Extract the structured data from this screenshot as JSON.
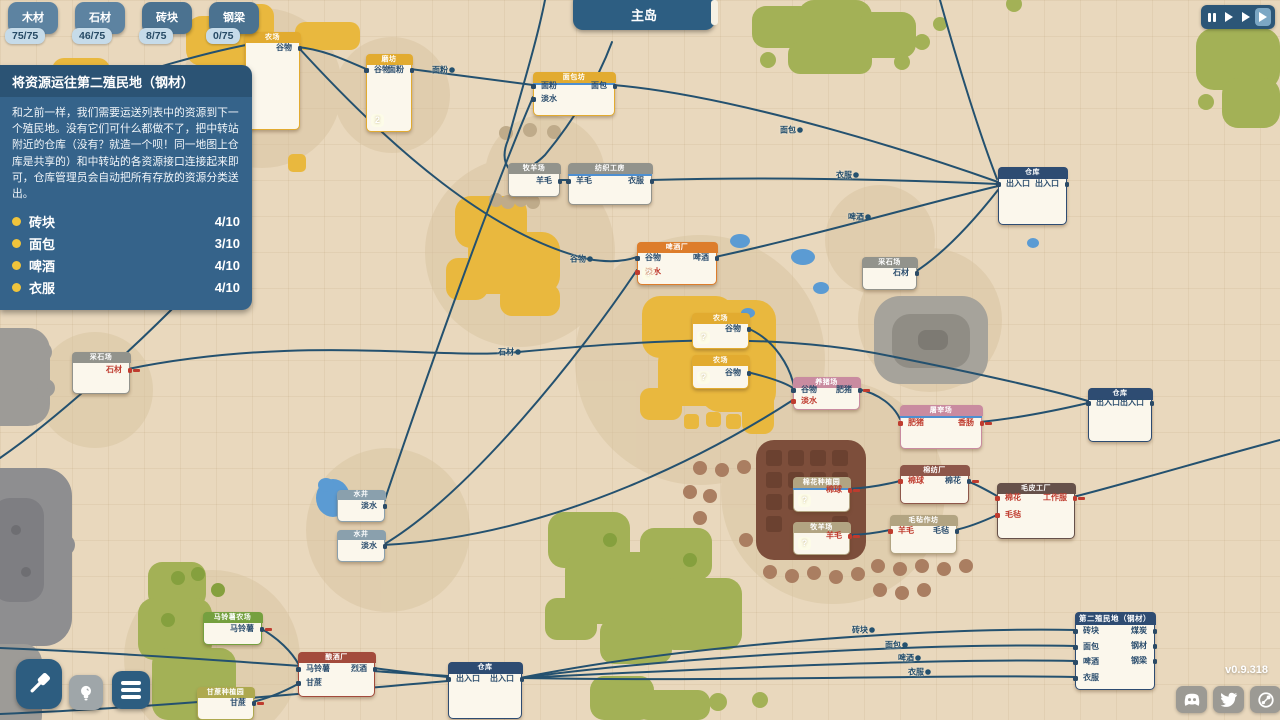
{
  "hud": {
    "map_title": "主岛",
    "version": "v0.9.318",
    "resources": [
      {
        "name": "木材",
        "count": "75/75"
      },
      {
        "name": "石材",
        "count": "46/75"
      },
      {
        "name": "砖块",
        "count": "8/75"
      },
      {
        "name": "钢梁",
        "count": "0/75"
      }
    ],
    "speed_buttons": [
      "pause",
      "play-1x",
      "play-2x",
      "play-3x"
    ],
    "speed_active_index": 3,
    "toolbar": [
      "build-hammer",
      "idea-bulb",
      "menu"
    ],
    "social": [
      "discord",
      "twitter",
      "steam"
    ]
  },
  "quest": {
    "title": "将资源运往第二殖民地（钢材）",
    "body": "和之前一样，我们需要运送列表中的资源到下一个殖民地。没有它们可什么都做不了，把中转站附近的仓库（没有？就造一个呗！同一地图上仓库是共享的）和中转站的各资源接口连接起来即可，仓库管理员会自动把所有存放的资源分类送出。",
    "items": [
      {
        "label": "砖块",
        "progress": "4/10"
      },
      {
        "label": "面包",
        "progress": "3/10"
      },
      {
        "label": "啤酒",
        "progress": "4/10"
      },
      {
        "label": "衣服",
        "progress": "4/10"
      }
    ]
  },
  "palette": {
    "yellow": "#e2ab30",
    "gray": "#92938c",
    "blue": "#2e4c72",
    "orange": "#dd7d2b",
    "pink": "#c98ba0",
    "brown": "#8e574a",
    "darkbrown": "#66514a",
    "tan": "#b2a482",
    "green": "#75a03f",
    "olive": "#aea94f",
    "darkred": "#a34b3c",
    "well": "#8aa0ad",
    "edge": "#24516f",
    "accent_yellow": "#f0c43c"
  },
  "nodes": [
    {
      "id": "farm-topleft",
      "type": "yellow",
      "title": "农场",
      "x": 245,
      "y": 32,
      "w": 53,
      "h": 96,
      "outputs": [
        {
          "label": "谷物",
          "dy": 15
        }
      ]
    },
    {
      "id": "mill",
      "type": "yellow",
      "title": "磨坊",
      "x": 366,
      "y": 54,
      "w": 44,
      "h": 76,
      "badge": "2",
      "inputs": [
        {
          "label": "谷物",
          "dy": 15
        }
      ],
      "outputs": [
        {
          "label": "面粉",
          "dy": 15
        }
      ]
    },
    {
      "id": "bakery",
      "type": "yellow",
      "title": "面包坊",
      "x": 533,
      "y": 72,
      "w": 80,
      "h": 42,
      "progress": true,
      "inputs": [
        {
          "label": "面粉",
          "dy": 13
        },
        {
          "label": "淡水",
          "dy": 26
        }
      ],
      "outputs": [
        {
          "label": "面包",
          "dy": 13
        }
      ]
    },
    {
      "id": "sheepfarm-top",
      "type": "gray",
      "title": "牧羊场",
      "x": 508,
      "y": 163,
      "w": 50,
      "h": 32,
      "outputs": [
        {
          "label": "羊毛",
          "dy": 17
        }
      ]
    },
    {
      "id": "textile",
      "type": "gray",
      "title": "纺织工房",
      "x": 568,
      "y": 163,
      "w": 82,
      "h": 40,
      "progress": true,
      "inputs": [
        {
          "label": "羊毛",
          "dy": 17
        }
      ],
      "outputs": [
        {
          "label": "衣服",
          "dy": 17
        }
      ]
    },
    {
      "id": "warehouse-topright",
      "type": "blue",
      "title": "仓库",
      "x": 998,
      "y": 167,
      "w": 67,
      "h": 56,
      "hh": 12,
      "inputs": [
        {
          "label": "出入口",
          "dy": 16
        }
      ],
      "outputs": [
        {
          "label": "出入口",
          "dy": 16
        }
      ]
    },
    {
      "id": "brewery",
      "type": "orange",
      "title": "啤酒厂",
      "x": 637,
      "y": 242,
      "w": 78,
      "h": 41,
      "badge": "?",
      "inputs": [
        {
          "label": "谷物",
          "dy": 15
        },
        {
          "label": "淡水",
          "dy": 29,
          "red": true
        }
      ],
      "outputs": [
        {
          "label": "啤酒",
          "dy": 15
        }
      ]
    },
    {
      "id": "quarry-right",
      "type": "gray",
      "title": "采石场",
      "x": 862,
      "y": 257,
      "w": 53,
      "h": 31,
      "outputs": [
        {
          "label": "石材",
          "dy": 15
        }
      ]
    },
    {
      "id": "quarry-left",
      "type": "gray",
      "title": "采石场",
      "x": 72,
      "y": 352,
      "w": 56,
      "h": 40,
      "outputs": [
        {
          "label": "石材",
          "dy": 17,
          "red": true,
          "stub": true
        }
      ]
    },
    {
      "id": "farm-mid1",
      "type": "yellow",
      "title": "农场",
      "x": 692,
      "y": 313,
      "w": 55,
      "h": 34,
      "badge": "?",
      "outputs": [
        {
          "label": "谷物",
          "dy": 15
        }
      ]
    },
    {
      "id": "farm-mid2",
      "type": "yellow",
      "title": "农场",
      "x": 692,
      "y": 355,
      "w": 55,
      "h": 32,
      "badge": "?",
      "outputs": [
        {
          "label": "谷物",
          "dy": 17
        }
      ]
    },
    {
      "id": "pigfarm",
      "type": "pink",
      "title": "养猪场",
      "x": 793,
      "y": 377,
      "w": 65,
      "h": 31,
      "inputs": [
        {
          "label": "谷物",
          "dy": 12
        },
        {
          "label": "淡水",
          "dy": 23,
          "red": true
        }
      ],
      "outputs": [
        {
          "label": "肥猪",
          "dy": 12,
          "stub": true
        }
      ]
    },
    {
      "id": "slaughterhouse",
      "type": "pink",
      "title": "屠宰场",
      "x": 900,
      "y": 405,
      "w": 80,
      "h": 42,
      "progress": true,
      "inputs": [
        {
          "label": "肥猪",
          "dy": 17,
          "red": true
        }
      ],
      "outputs": [
        {
          "label": "香肠",
          "dy": 17,
          "red": true,
          "stub": true
        }
      ]
    },
    {
      "id": "warehouse-right",
      "type": "blue",
      "title": "仓库",
      "x": 1088,
      "y": 388,
      "w": 62,
      "h": 52,
      "hh": 12,
      "inputs": [
        {
          "label": "出入口",
          "dy": 14
        }
      ],
      "outputs": [
        {
          "label": "出入口",
          "dy": 14
        }
      ]
    },
    {
      "id": "well-1",
      "type": "well",
      "title": "水井",
      "x": 337,
      "y": 490,
      "w": 46,
      "h": 30,
      "hh": 10,
      "outputs": [
        {
          "label": "淡水",
          "dy": 15
        }
      ]
    },
    {
      "id": "well-2",
      "type": "well",
      "title": "水井",
      "x": 337,
      "y": 530,
      "w": 46,
      "h": 30,
      "hh": 10,
      "outputs": [
        {
          "label": "淡水",
          "dy": 15
        }
      ]
    },
    {
      "id": "cotton-mill",
      "type": "brown",
      "title": "棉纺厂",
      "x": 900,
      "y": 465,
      "w": 67,
      "h": 37,
      "inputs": [
        {
          "label": "棉球",
          "dy": 15,
          "red": true
        }
      ],
      "outputs": [
        {
          "label": "棉花",
          "dy": 15,
          "stub": true
        }
      ]
    },
    {
      "id": "felt-workshop",
      "type": "tan",
      "title": "毛毡作坊",
      "x": 890,
      "y": 515,
      "w": 65,
      "h": 37,
      "inputs": [
        {
          "label": "羊毛",
          "dy": 15,
          "red": true
        }
      ],
      "outputs": [
        {
          "label": "毛毡",
          "dy": 15
        }
      ]
    },
    {
      "id": "garment-factory",
      "type": "darkbrown",
      "title": "毛皮工厂",
      "x": 997,
      "y": 483,
      "w": 76,
      "h": 54,
      "inputs": [
        {
          "label": "棉花",
          "dy": 14,
          "red": true
        },
        {
          "label": "毛毡",
          "dy": 31,
          "red": true
        }
      ],
      "outputs": [
        {
          "label": "工作服",
          "dy": 14,
          "red": true,
          "stub": true
        }
      ]
    },
    {
      "id": "cotton-plantation",
      "type": "tan",
      "title": "棉花种植园",
      "x": 793,
      "y": 477,
      "w": 55,
      "h": 33,
      "progress": true,
      "badge": "?",
      "outputs": [
        {
          "label": "棉球",
          "dy": 12,
          "red": true,
          "stub": true
        }
      ]
    },
    {
      "id": "sheepfarm-bottom",
      "type": "tan",
      "title": "牧羊场",
      "x": 793,
      "y": 522,
      "w": 55,
      "h": 31,
      "badge": "?",
      "outputs": [
        {
          "label": "羊毛",
          "dy": 13,
          "red": true,
          "stub": true
        }
      ]
    },
    {
      "id": "potato-farm",
      "type": "green",
      "title": "马铃薯农场",
      "x": 203,
      "y": 612,
      "w": 57,
      "h": 31,
      "outputs": [
        {
          "label": "马铃薯",
          "dy": 16,
          "stub": true
        }
      ]
    },
    {
      "id": "sugar-plantation",
      "type": "olive",
      "title": "甘蔗种植园",
      "x": 197,
      "y": 687,
      "w": 55,
      "h": 31,
      "outputs": [
        {
          "label": "甘蔗",
          "dy": 15,
          "stub": true
        }
      ]
    },
    {
      "id": "distillery",
      "type": "darkred",
      "title": "酿酒厂",
      "x": 298,
      "y": 652,
      "w": 75,
      "h": 43,
      "inputs": [
        {
          "label": "马铃薯",
          "dy": 16
        },
        {
          "label": "甘蔗",
          "dy": 30
        }
      ],
      "outputs": [
        {
          "label": "烈酒",
          "dy": 16
        }
      ]
    },
    {
      "id": "warehouse-bottom",
      "type": "blue",
      "title": "仓库",
      "x": 448,
      "y": 662,
      "w": 72,
      "h": 55,
      "hh": 12,
      "inputs": [
        {
          "label": "出入口",
          "dy": 16
        }
      ],
      "outputs": [
        {
          "label": "出入口",
          "dy": 16
        }
      ]
    },
    {
      "id": "colony",
      "type": "blue",
      "title": "第二殖民地（钢材）",
      "x": 1075,
      "y": 612,
      "w": 78,
      "h": 76,
      "hh": 13,
      "inputs": [
        {
          "label": "砖块",
          "dy": 18
        },
        {
          "label": "面包",
          "dy": 34
        },
        {
          "label": "啤酒",
          "dy": 49
        },
        {
          "label": "衣服",
          "dy": 65
        }
      ],
      "outputs": [
        {
          "label": "煤炭",
          "dy": 18
        },
        {
          "label": "钢材",
          "dy": 33
        },
        {
          "label": "钢梁",
          "dy": 48
        }
      ]
    }
  ],
  "edges": [
    {
      "d": "M298,47 C325,50 345,60 366,69"
    },
    {
      "d": "M410,69 C448,74 496,80 533,85",
      "label": "面粉",
      "lx": 452,
      "ly": 70
    },
    {
      "d": "M613,85 C710,93 862,134 998,182",
      "label": "面包",
      "lx": 800,
      "ly": 130
    },
    {
      "d": "M650,180 C760,177 882,179 998,184",
      "label": "衣服",
      "lx": 856,
      "ly": 175
    },
    {
      "d": "M558,180 L568,180"
    },
    {
      "d": "M715,257 C812,236 916,206 998,186",
      "label": "啤酒",
      "lx": 868,
      "ly": 217
    },
    {
      "d": "M915,272 C946,252 976,218 998,190"
    },
    {
      "d": "M940,0 C958,65 980,135 997,179"
    },
    {
      "d": "M383,505 C428,372 492,192 533,97"
    },
    {
      "d": "M298,47 C392,150 492,236 588,259 C610,263 626,261 637,257",
      "label": "谷物",
      "lx": 590,
      "ly": 259
    },
    {
      "d": "M383,545 C472,492 582,352 637,270"
    },
    {
      "d": "M383,545 C562,536 722,446 793,400"
    },
    {
      "d": "M747,328 C776,340 790,368 794,386"
    },
    {
      "d": "M747,372 C768,377 784,382 793,388"
    },
    {
      "d": "M858,389 C880,394 894,406 900,419"
    },
    {
      "d": "M980,422 C1020,418 1058,410 1088,403"
    },
    {
      "d": "M128,369 C300,334 440,360 518,352 C650,340 772,332 890,356 C990,376 1058,392 1088,401",
      "label": "石材",
      "lx": 518,
      "ly": 352
    },
    {
      "d": "M848,489 C868,488 884,485 900,481"
    },
    {
      "d": "M967,481 C978,485 988,491 997,496"
    },
    {
      "d": "M848,535 C864,535 876,533 890,530"
    },
    {
      "d": "M955,530 C970,527 984,521 997,515"
    },
    {
      "d": "M1073,497 C1132,482 1212,458 1280,440"
    },
    {
      "d": "M260,628 C278,638 292,652 299,665"
    },
    {
      "d": "M252,702 C270,698 285,691 298,684"
    },
    {
      "d": "M373,668 C398,671 425,675 448,677"
    },
    {
      "d": "M520,678 C700,642 950,627 1075,630",
      "label": "砖块",
      "lx": 872,
      "ly": 630
    },
    {
      "d": "M520,678 C700,654 950,643 1075,646",
      "label": "面包",
      "lx": 905,
      "ly": 645
    },
    {
      "d": "M520,678 C720,668 950,658 1075,661",
      "label": "啤酒",
      "lx": 918,
      "ly": 658
    },
    {
      "d": "M520,678 C750,682 950,674 1075,677",
      "label": "衣服",
      "lx": 928,
      "ly": 672
    },
    {
      "d": "M0,648 C150,654 320,668 448,676"
    },
    {
      "d": "M0,714 C150,708 320,692 448,681"
    },
    {
      "d": "M0,113 C70,98 160,62 246,45"
    },
    {
      "d": "M186,295 C130,352 55,420 0,458"
    },
    {
      "d": "M545,0 C536,45 520,95 508,140 C503,152 503,162 510,170"
    },
    {
      "d": "M612,42 C596,85 570,125 545,155 C536,164 526,170 516,173"
    }
  ]
}
